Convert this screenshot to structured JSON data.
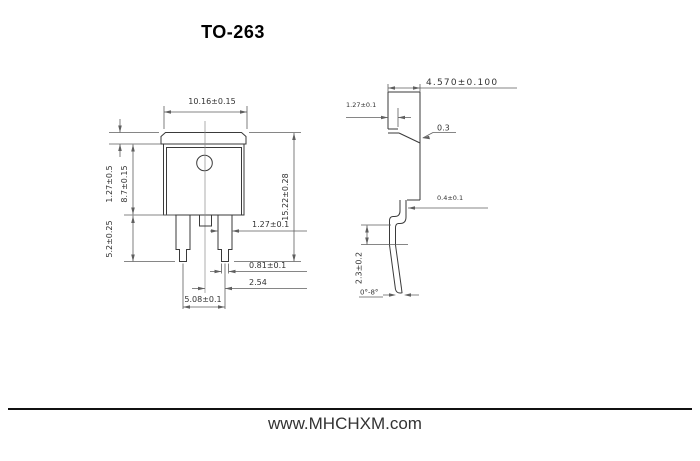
{
  "title": "TO-263",
  "footer": {
    "website": "www.MHCHXM.com"
  },
  "front_view": {
    "dims": {
      "body_width": "10.16±0.15",
      "tab_height": "1.27±0.5",
      "body_height": "8.7±0.15",
      "lead_length": "5.2±0.25",
      "overall_height": "15.22±0.28",
      "lead_width": "1.27±0.1",
      "lead_tip_width": "0.81±0.1",
      "lead_pitch": "2.54",
      "lead_span": "5.08±0.1"
    }
  },
  "side_view": {
    "dims": {
      "overall_depth": "4.570±0.100",
      "tab_thickness": "1.27±0.1",
      "tab_step": "0.3",
      "lead_thickness": "0.4±0.1",
      "lead_height": "2.3±0.2",
      "lead_angle": "0°-8°"
    }
  }
}
